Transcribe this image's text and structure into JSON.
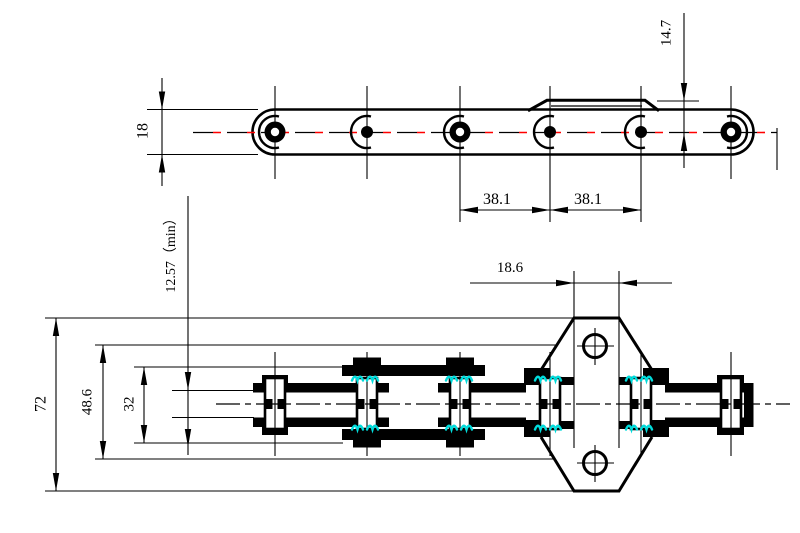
{
  "drawing": {
    "description": "Engineering drawing of a double-pitch conveyor roller chain with bent K-type attachment",
    "side_view_name": "chain side elevation with raised attachment link",
    "plan_view_name": "chain plan view with attachment plate and two holes"
  },
  "dims": {
    "d18": {
      "label": "18"
    },
    "d147": {
      "label": "14.7"
    },
    "d381a": {
      "label": "38.1"
    },
    "d381b": {
      "label": "38.1"
    },
    "d186": {
      "label": "18.6"
    },
    "d1257": {
      "label": "12.57（min）"
    },
    "d72": {
      "label": "72"
    },
    "d486": {
      "label": "48.6"
    },
    "d32": {
      "label": "32"
    }
  },
  "colors": {
    "line": "#000000",
    "centerline_red": "#ff0000",
    "hatch_cyan": "#00dcdc",
    "dim_text_blue": "#23379b",
    "background": "#ffffff"
  }
}
